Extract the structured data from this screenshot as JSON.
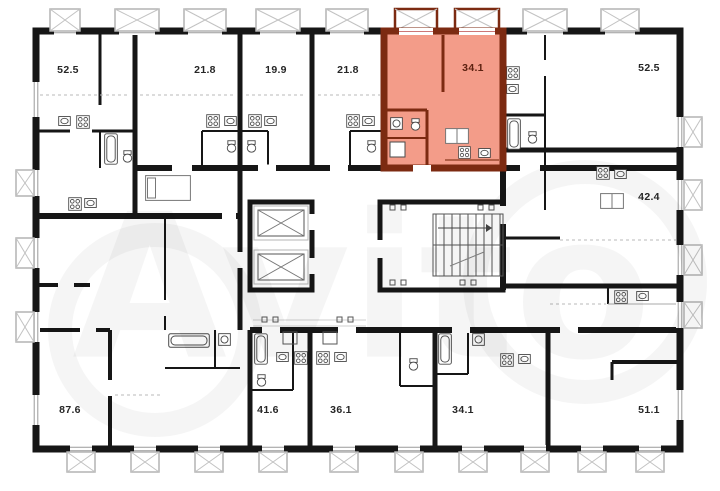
{
  "plan": {
    "type": "building-floor-plan",
    "watermark_text": "Avito",
    "highlighted_unit_area": "34.1"
  },
  "colors": {
    "wall": "#161616",
    "hl_fill": "#f39c89",
    "hl_wall": "#7c2a11",
    "hl_label": "#5c2110",
    "label": "#262626",
    "balcony_stroke": "#b3b3b3",
    "fixture": "#4a4a4a"
  },
  "units": [
    {
      "id": "unit-52-5-top-left",
      "area": "52.5",
      "highlighted": false,
      "x": 68,
      "y": 70
    },
    {
      "id": "unit-21-8-a",
      "area": "21.8",
      "highlighted": false,
      "x": 205,
      "y": 70
    },
    {
      "id": "unit-19-9",
      "area": "19.9",
      "highlighted": false,
      "x": 276,
      "y": 70
    },
    {
      "id": "unit-21-8-b",
      "area": "21.8",
      "highlighted": false,
      "x": 348,
      "y": 70
    },
    {
      "id": "unit-34-1-top",
      "area": "34.1",
      "highlighted": true,
      "x": 473,
      "y": 68
    },
    {
      "id": "unit-52-5-top-right",
      "area": "52.5",
      "highlighted": false,
      "x": 649,
      "y": 68
    },
    {
      "id": "unit-42-4",
      "area": "42.4",
      "highlighted": false,
      "x": 649,
      "y": 197
    },
    {
      "id": "unit-87-6",
      "area": "87.6",
      "highlighted": false,
      "x": 70,
      "y": 410
    },
    {
      "id": "unit-41-6",
      "area": "41.6",
      "highlighted": false,
      "x": 268,
      "y": 410
    },
    {
      "id": "unit-36-1",
      "area": "36.1",
      "highlighted": false,
      "x": 341,
      "y": 410
    },
    {
      "id": "unit-34-1-bottom",
      "area": "34.1",
      "highlighted": false,
      "x": 463,
      "y": 410
    },
    {
      "id": "unit-51-1",
      "area": "51.1",
      "highlighted": false,
      "x": 649,
      "y": 410
    }
  ],
  "core": {
    "elevators": 2,
    "has_staircase": true
  },
  "icons": [
    "stove-icon",
    "sink-icon",
    "bathtub-icon",
    "toilet-icon",
    "washer-icon",
    "wardrobe-icon",
    "bed-icon",
    "elevator-icon",
    "staircase-icon",
    "balcony-icon",
    "window-icon",
    "avito-watermark"
  ]
}
